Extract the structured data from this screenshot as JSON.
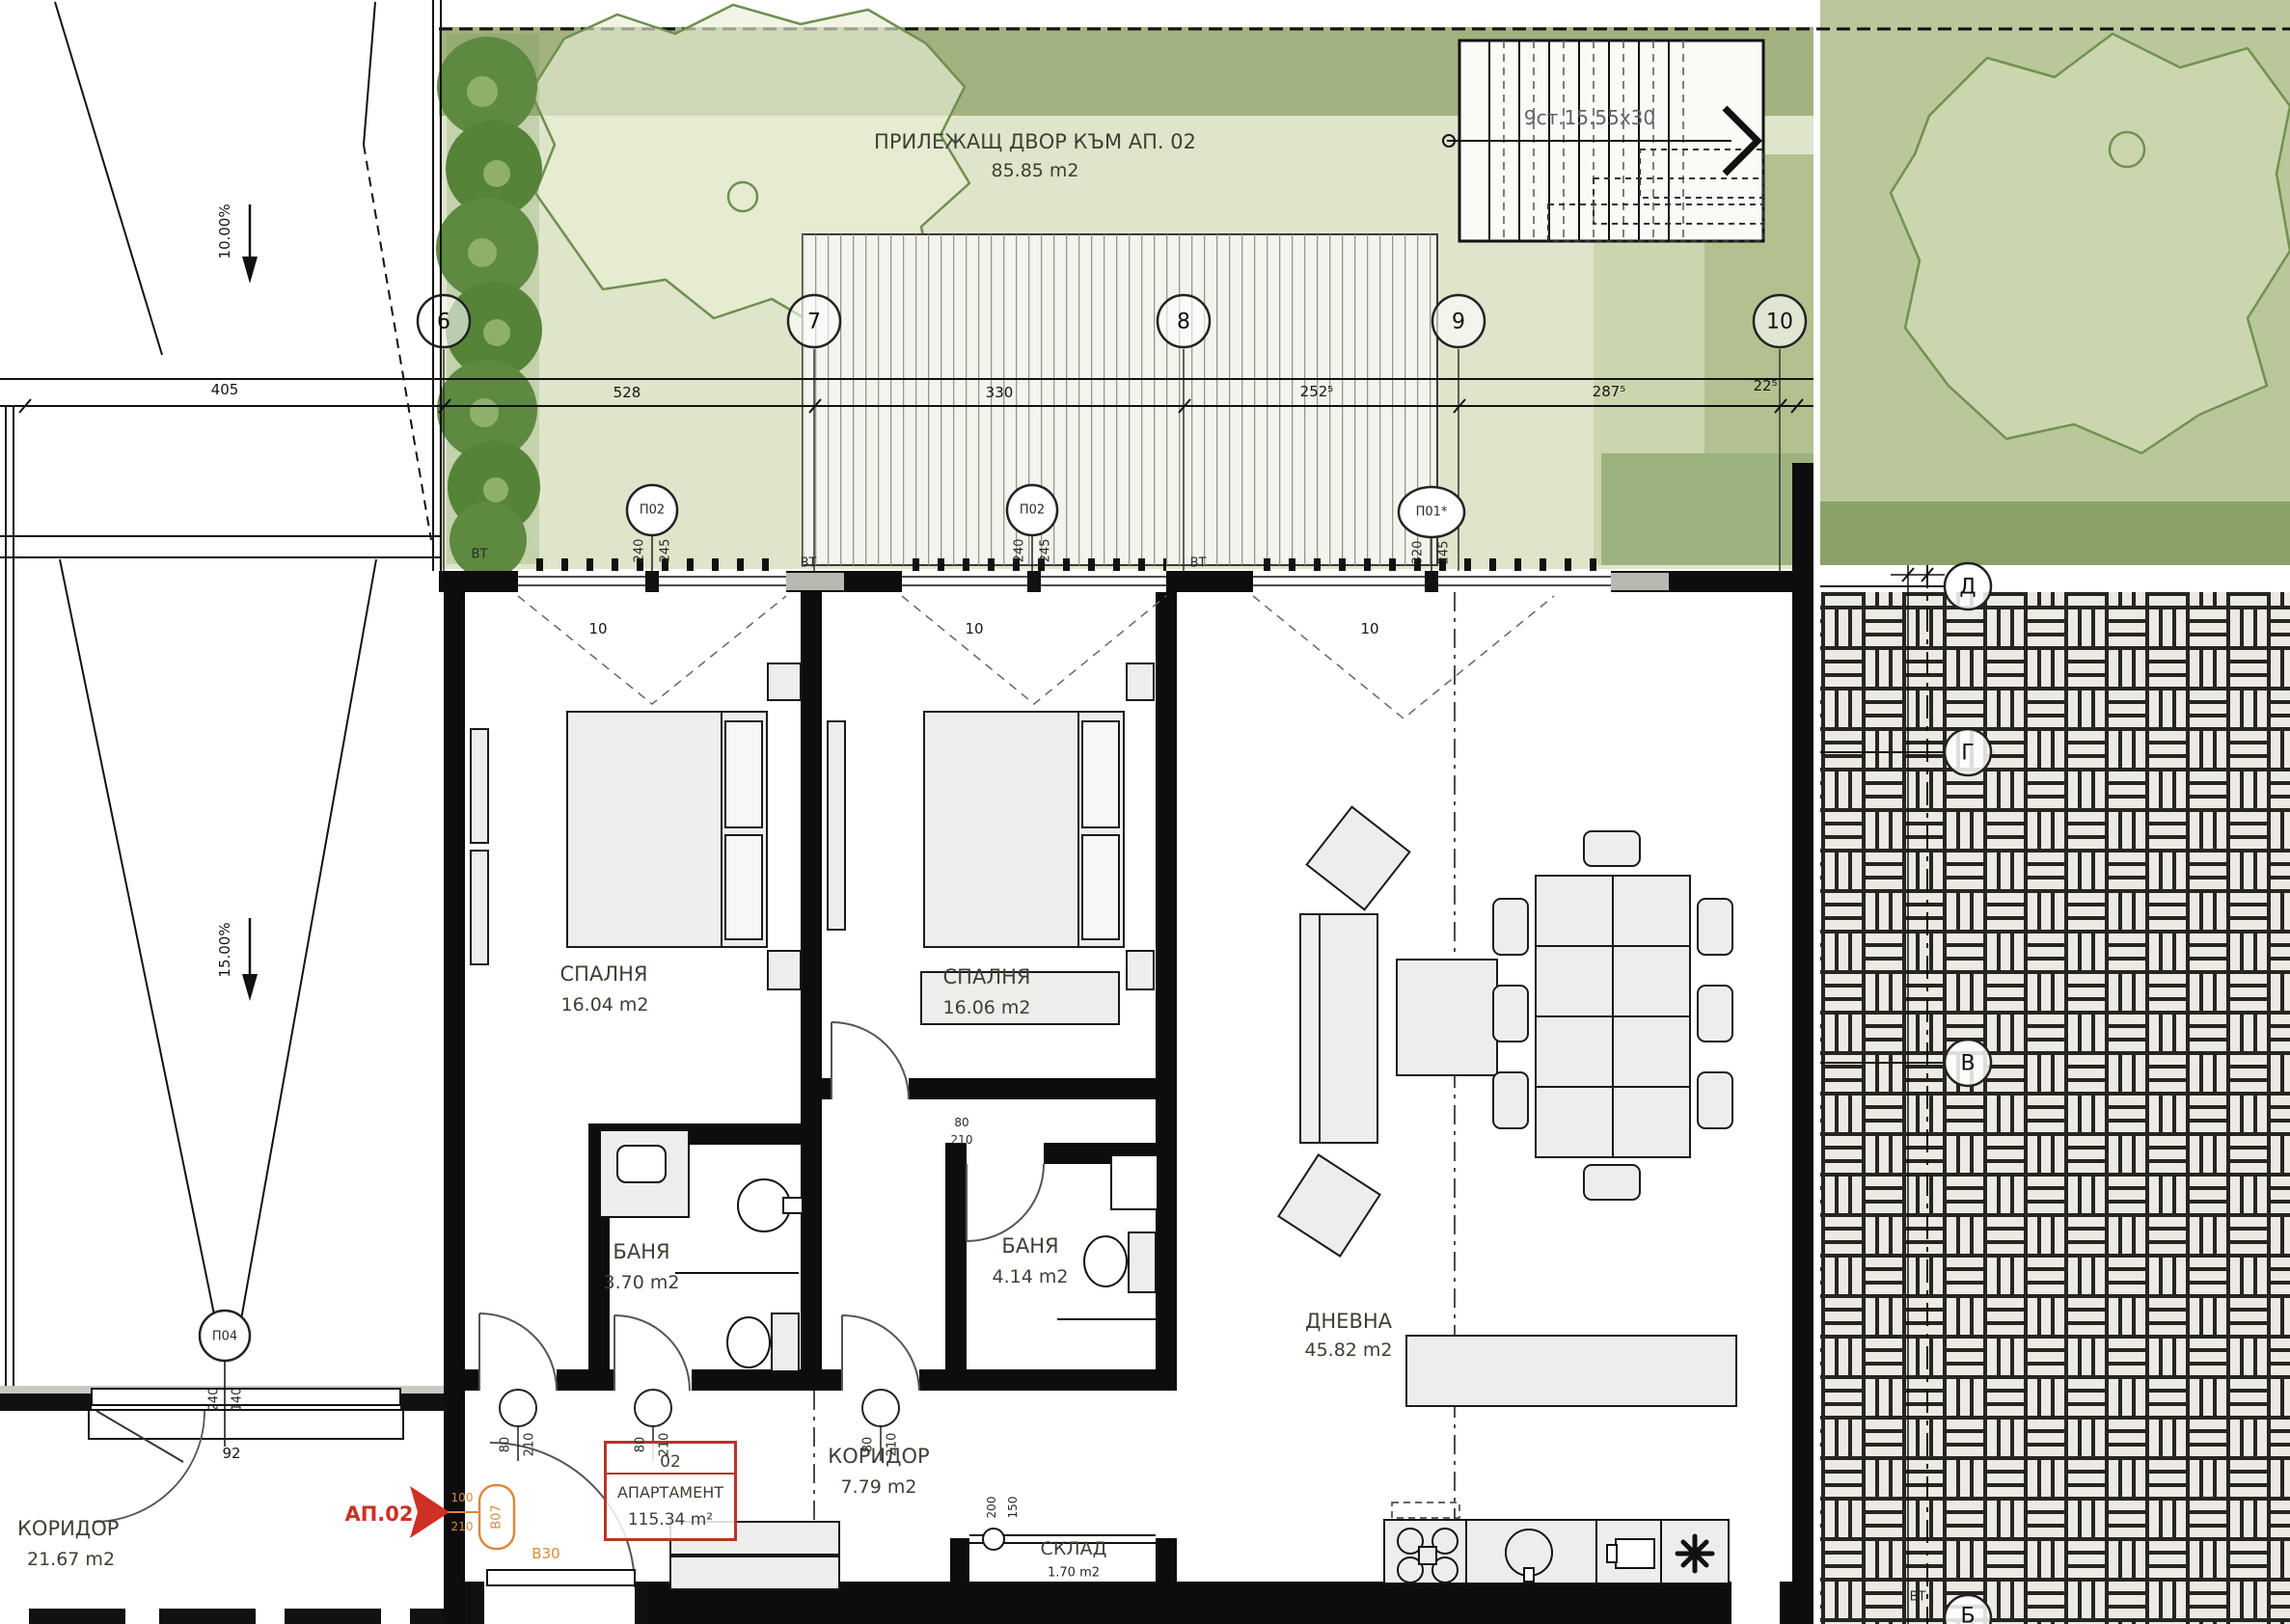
{
  "yard": {
    "label": "ПРИЛЕЖАЩ ДВОР КЪМ АП. 02",
    "area": "85.85 m2"
  },
  "stairs_note": "9ст.15.55х30",
  "grid": {
    "g6": "6",
    "g7": "7",
    "g8": "8",
    "g9": "9",
    "g10": "10",
    "gd": "Д",
    "gg": "Г",
    "gv": "В",
    "gb": "Б"
  },
  "dims": {
    "d405": "405",
    "d528": "528",
    "d330": "330",
    "d2525": "252⁵",
    "d2875": "287⁵",
    "d225": "22⁵",
    "d92": "92",
    "d10": "10",
    "door_w": "80",
    "door_h": "210",
    "entry_w": "100",
    "entry_h": "210",
    "storage_w": "200",
    "storage_h": "150"
  },
  "windows": {
    "p02": "П02",
    "p01": "П01*",
    "p04": "П04",
    "w240": "240",
    "w245": "245",
    "w320": "320",
    "w140": "140"
  },
  "vt": "ВТ",
  "slopes": {
    "s10": "10.00%",
    "s15": "15.00%"
  },
  "rooms": {
    "bedroom1": {
      "name": "СПАЛНЯ",
      "area": "16.04 m2"
    },
    "bedroom2": {
      "name": "СПАЛНЯ",
      "area": "16.06 m2"
    },
    "bath1": {
      "name": "БАНЯ",
      "area": "3.70 m2"
    },
    "bath2": {
      "name": "БАНЯ",
      "area": "4.14 m2"
    },
    "living": {
      "name": "ДНЕВНА",
      "area": "45.82 m2"
    },
    "hall": {
      "name": "КОРИДОР",
      "area": "7.79 m2"
    },
    "corridor": {
      "name": "КОРИДОР",
      "area": "21.67 m2"
    },
    "storage": {
      "name": "СКЛАД",
      "area": "1.70 m2"
    }
  },
  "apartment": {
    "number": "02",
    "label": "АПАРТАМЕНТ",
    "area": "115.34 m²"
  },
  "entrance": {
    "ap": "АП.02",
    "tag_door": "В07",
    "tag_fire": "В30"
  },
  "colors": {
    "accent_red": "#c7382b",
    "accent_orange": "#d98a3f",
    "green_dark": "#9fb37e",
    "green_light": "#dfe5cb"
  }
}
